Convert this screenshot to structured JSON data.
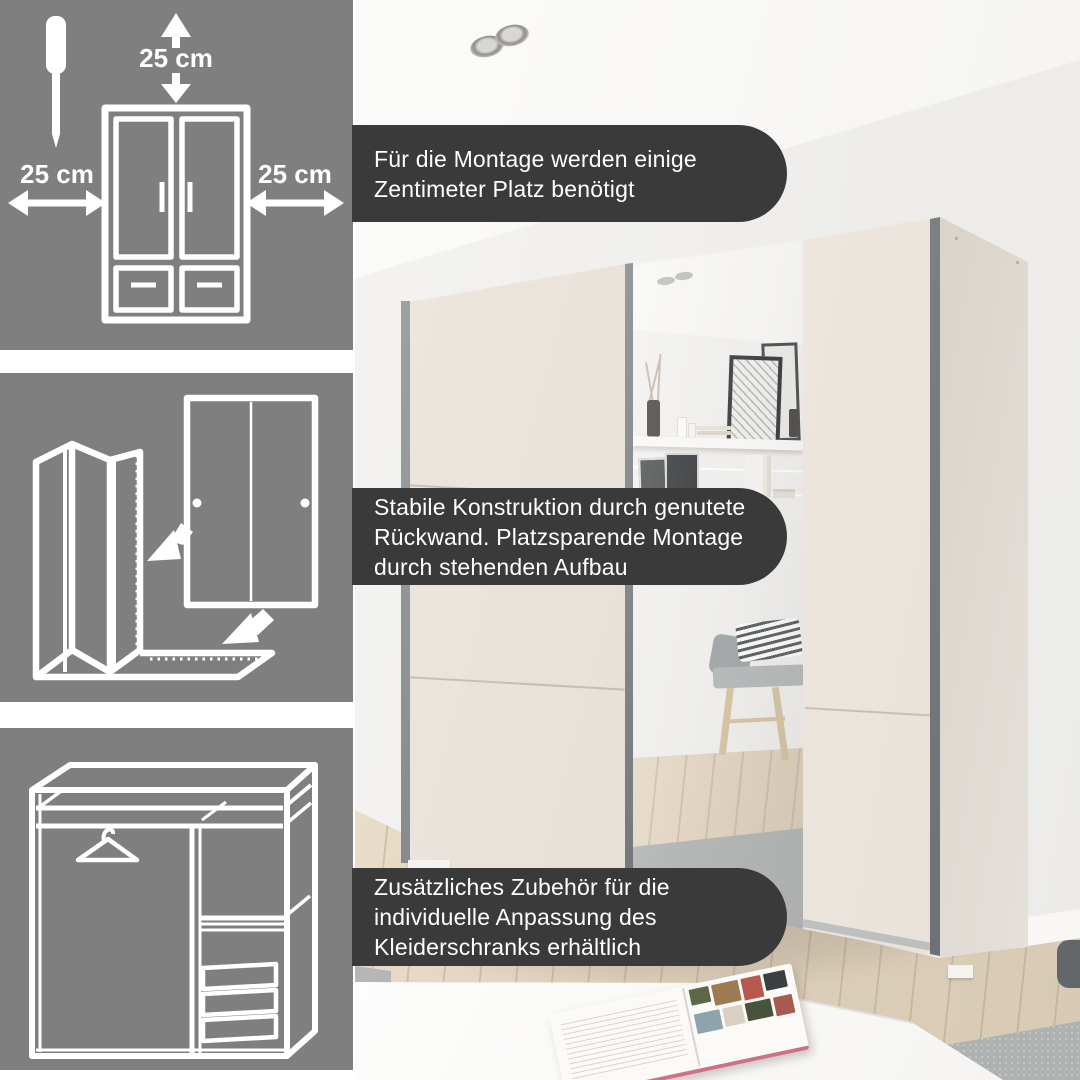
{
  "colors": {
    "panel_bg": "#7f7f7f",
    "callout_bg": "#3a3a3a",
    "callout_text": "#ffffff",
    "door_cream": "#eae4dc",
    "profile_gray": "#6f7376",
    "wall": "#f0efed",
    "floor_wood": "#dccfbb",
    "rug_gray": "#aeb2b0",
    "magazine_edge": "#cf7186"
  },
  "panels": {
    "clearance": {
      "icons": [
        "screwdriver-icon",
        "wardrobe-front-icon",
        "clearance-arrow-icons"
      ],
      "labels": {
        "top": "25 cm",
        "left": "25 cm",
        "right": "25 cm"
      }
    },
    "assembly": {
      "icons": [
        "carcass-3d-icon",
        "sliding-door-icon",
        "insert-arrow-icons"
      ]
    },
    "interior": {
      "icons": [
        "wardrobe-interior-icon",
        "hanger-icon",
        "drawers-icon"
      ]
    }
  },
  "callouts": [
    {
      "lines": [
        "Für die Montage werden einige",
        "Zentimeter Platz benötigt"
      ]
    },
    {
      "lines": [
        "Stabile Konstruktion durch genutete",
        "Rückwand. Platzsparende Montage",
        "durch stehenden Aufbau"
      ]
    },
    {
      "lines": [
        "Zusätzliches Zubehör für die",
        "individuelle Anpassung des",
        "Kleiderschranks erhältlich"
      ]
    }
  ],
  "magazine_photo_colors": [
    "#5d6647",
    "#9c7a52",
    "#b8574d",
    "#3c3f41",
    "#8fa3ad",
    "#d9d2c4",
    "#49523c",
    "#a85b50"
  ]
}
